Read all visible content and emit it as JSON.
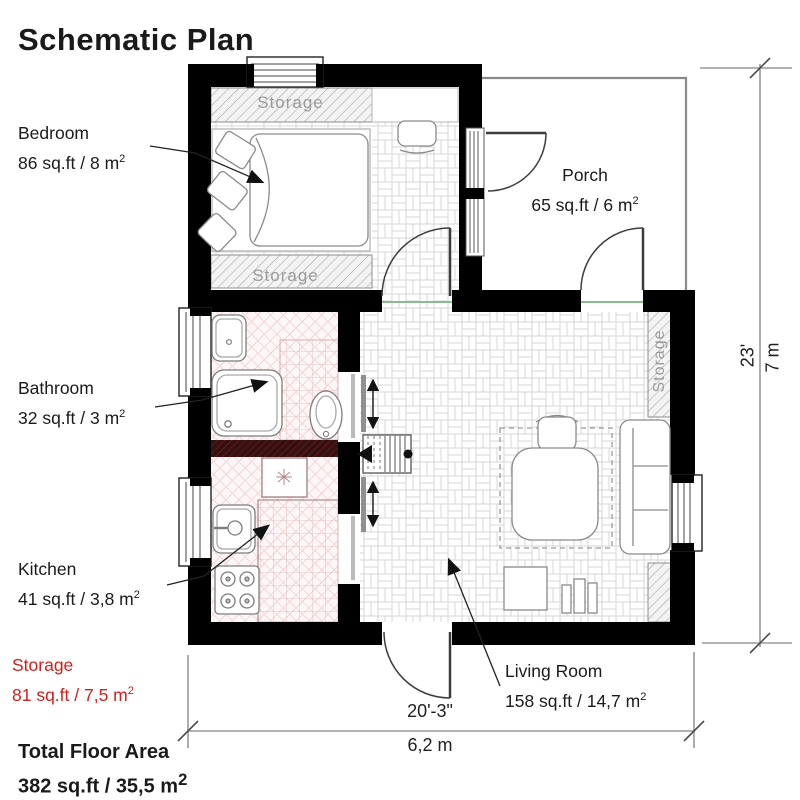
{
  "title": "Schematic Plan",
  "rooms": {
    "bedroom": {
      "label": "Bedroom",
      "area": "86 sq.ft / 8 m",
      "area_sup": "2"
    },
    "porch": {
      "label": "Porch",
      "area": "65 sq.ft / 6 m",
      "area_sup": "2"
    },
    "bathroom": {
      "label": "Bathroom",
      "area": "32 sq.ft / 3 m",
      "area_sup": "2"
    },
    "kitchen": {
      "label": "Kitchen",
      "area": "41 sq.ft / 3,8 m",
      "area_sup": "2"
    },
    "storage": {
      "label": "Storage",
      "area": "81 sq.ft / 7,5 m",
      "area_sup": "2"
    },
    "living_room": {
      "label": "Living Room",
      "area": "158 sq.ft / 14,7 m",
      "area_sup": "2"
    }
  },
  "total": {
    "label": "Total Floor Area",
    "area": "382 sq.ft / 35,5 m",
    "area_sup": "2"
  },
  "plan_annotations": {
    "storage_top": "Storage",
    "storage_bottom": "Storage",
    "storage_right": "Storage"
  },
  "dimensions": {
    "width_imperial": "20'-3\"",
    "width_metric": "6,2 m",
    "height_imperial": "23'",
    "height_metric": "7 m"
  },
  "colors": {
    "wall": "#000000",
    "accent_red": "#d21e1e",
    "storage_text_gray": "#9b9b9b",
    "pink_floor_hatch": "#e5b6b6",
    "parquet_line": "#d6d6d6",
    "threshold_green": "#8cba8c"
  }
}
